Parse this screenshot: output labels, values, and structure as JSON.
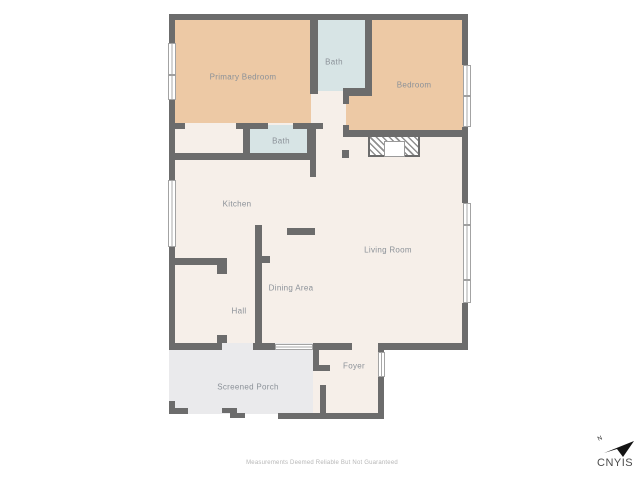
{
  "floorplan": {
    "rooms": {
      "primary_bedroom": {
        "label": "Primary Bedroom"
      },
      "bath_upper": {
        "label": "Bath"
      },
      "bedroom": {
        "label": "Bedroom"
      },
      "bath_lower": {
        "label": "Bath"
      },
      "kitchen": {
        "label": "Kitchen"
      },
      "living_room": {
        "label": "Living Room"
      },
      "dining_area": {
        "label": "Dining Area"
      },
      "hall": {
        "label": "Hall"
      },
      "foyer": {
        "label": "Foyer"
      },
      "screened_porch": {
        "label": "Screened Porch"
      }
    },
    "colors": {
      "bedroom_fill": "#edc9a5",
      "bath_fill": "#d7e4e5",
      "floor_fill": "#f6efe9",
      "porch_fill": "#eaeaec",
      "wall": "#6c6c6c",
      "label_text": "#8b9198"
    },
    "footer": {
      "disclaimer": "Measurements Deemed Reliable But Not Guaranteed"
    },
    "branding": {
      "logo_text": "CNYIS",
      "north_label": "N"
    }
  }
}
